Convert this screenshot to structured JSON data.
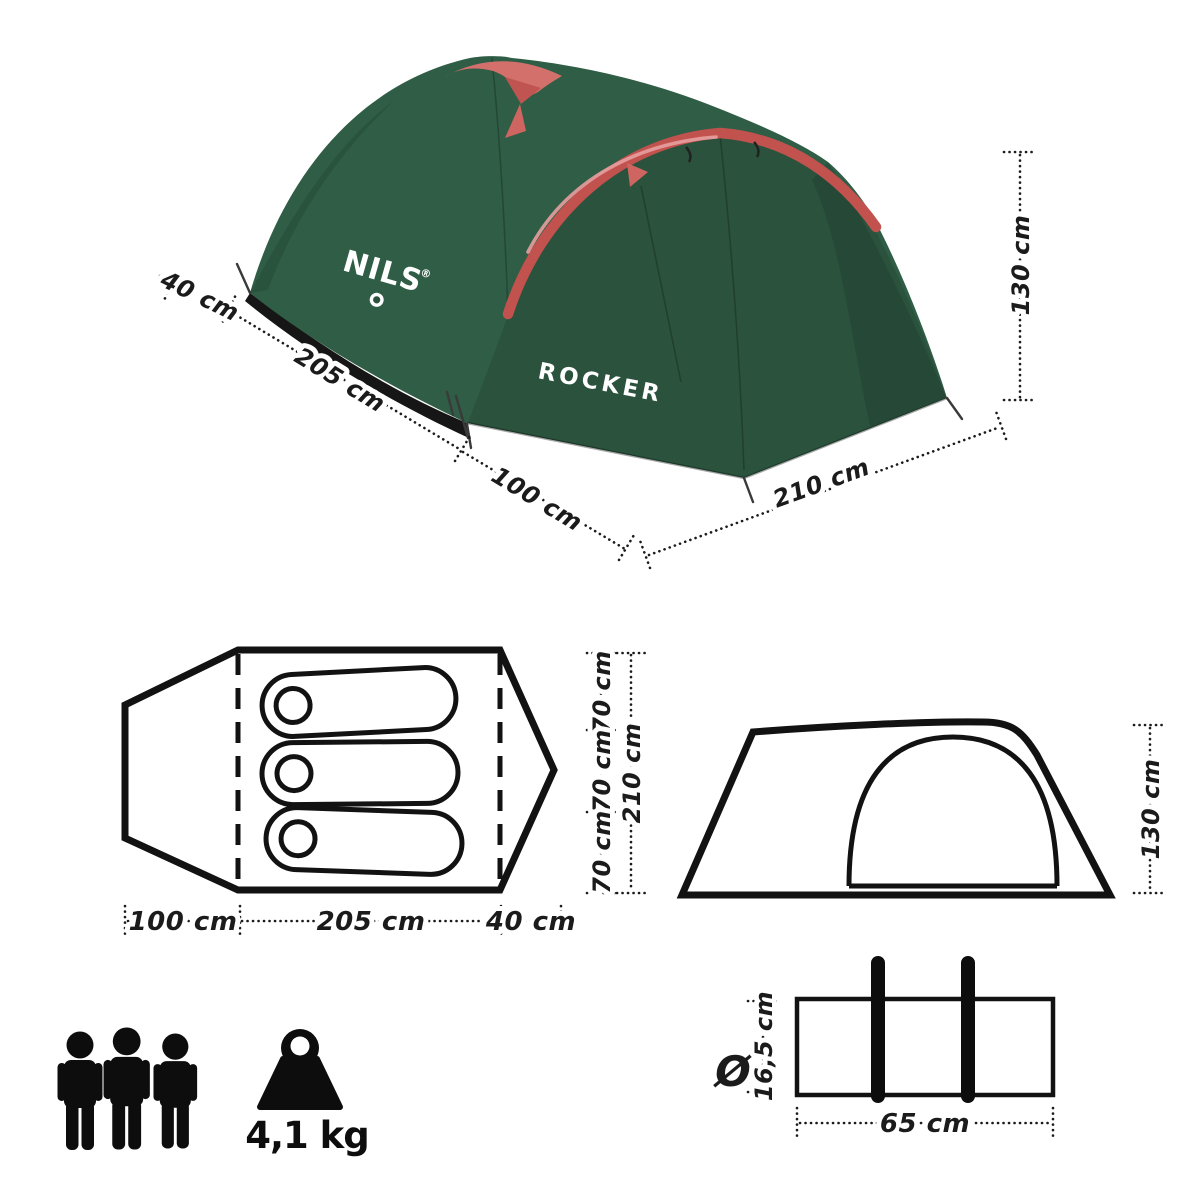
{
  "product": {
    "brand": "NILS",
    "brand_registered_mark": "®",
    "model": "ROCKER"
  },
  "tent_photo": {
    "dims": {
      "porch_depth": "40 cm",
      "inner_length": "205 cm",
      "vestibule_length": "100 cm",
      "width": "210 cm",
      "height": "130 cm"
    }
  },
  "floor_plan": {
    "bottom_dims": [
      "100 cm",
      "205 cm",
      "40 cm"
    ],
    "right_segment_dims": [
      "70 cm",
      "70 cm",
      "70 cm"
    ],
    "right_total_dim": "210 cm",
    "sleeping_pads_count": 3
  },
  "side_view": {
    "height_dim": "130 cm"
  },
  "carry_bag": {
    "diameter_symbol": "Ø",
    "diameter_dim": "16,5 cm",
    "length_dim": "65 cm"
  },
  "specs": {
    "capacity_persons": 3,
    "weight": "4,1 kg"
  },
  "icons": {
    "capacity": "person-icon",
    "weight": "kettlebell-weight-icon"
  },
  "colors": {
    "tent_green": "#2f5d46",
    "tent_green_dark": "#2a523d",
    "pole_red": "#c2524e",
    "pole_pink": "#e7a0a0",
    "groundsheet_black": "#161616",
    "diagram_ink": "#1b1b1b",
    "logo_white": "#ffffff",
    "background": "#ffffff"
  }
}
